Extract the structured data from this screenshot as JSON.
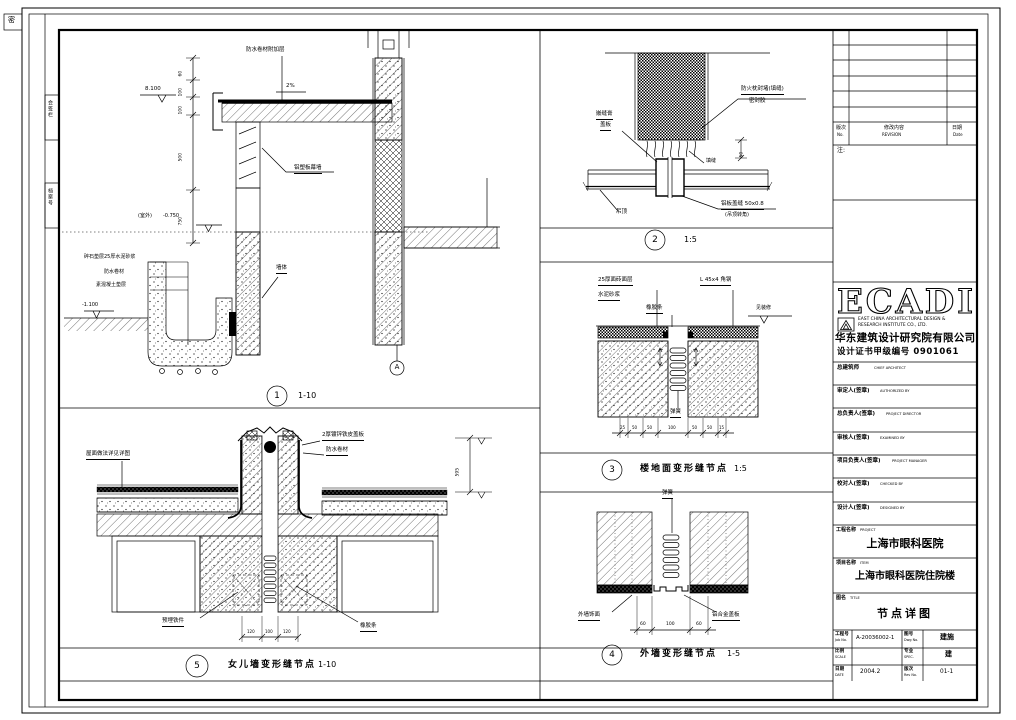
{
  "sheet": {
    "corner_stamp": "密",
    "strip_cell_1": "会签栏",
    "strip_cell_2": "档案号"
  },
  "revision_table": {
    "col_no_cn": "版次",
    "col_no_en": "No.",
    "col_rev_cn": "修改内容",
    "col_rev_en": "REVISION",
    "col_date_cn": "日期",
    "col_date_en": "Date",
    "note_label": "注:"
  },
  "ecadi": {
    "wordmark": "ECADI",
    "en_line1": "EAST CHINA ARCHITECTURAL DESIGN &",
    "en_line2": "RESEARCH INSTITUTE CO., LTD.",
    "cn_name": "华东建筑设计研究院有限公司",
    "cert_line": "设计证书甲级编号 0901061"
  },
  "signature_rows": [
    {
      "cn": "总建筑师",
      "en": "CHIEF ARCHITECT"
    },
    {
      "cn": "审定人(签章)",
      "en": "AUTHORIZED BY"
    },
    {
      "cn": "总负责人(签章)",
      "en": "PROJECT DIRECTOR"
    },
    {
      "cn": "审核人(签章)",
      "en": "EXAMINED BY"
    },
    {
      "cn": "项目负责人(签章)",
      "en": "PROJECT MANAGER"
    },
    {
      "cn": "校对人(签章)",
      "en": "CHECKED BY"
    },
    {
      "cn": "设计人(签章)",
      "en": "DESIGNED BY"
    }
  ],
  "project": {
    "label_cn": "工程名称",
    "label_en": "PROJECT",
    "value": "上海市眼科医院"
  },
  "subproject": {
    "label_cn": "项目名称",
    "label_en": "ITEM",
    "value": "上海市眼科医院住院楼"
  },
  "drawing_name": {
    "label_cn": "图名",
    "label_en": "TITLE",
    "value": "节点详图"
  },
  "info_grid": {
    "job_label_cn": "工程号",
    "job_label_en": "Job No.",
    "job_value": "A-20036002-1",
    "dwg_label_cn": "图号",
    "dwg_label_en": "Dwg No.",
    "dwg_value": "建施",
    "scale_label_cn": "比例",
    "scale_label_en": "SCALE",
    "scale_value": "",
    "spec_label_cn": "专业",
    "spec_label_en": "SPEC.",
    "spec_value": "建",
    "date_label_cn": "日期",
    "date_label_en": "DATE",
    "date_value": "2004.2",
    "rev_label_cn": "版次",
    "rev_label_en": "Rev No.",
    "rev_value": "01-1"
  },
  "details": {
    "d1": {
      "num": "1",
      "scale": "1-10",
      "elev_top": "8.100",
      "slope": "2%",
      "ann_membrane": "防水卷材附加层",
      "ann_curtain": "铝塑板幕墙",
      "ann_wall": "墙体",
      "ann_left_1": "碎石垫层25厚水泥砂浆",
      "ann_left_2": "防水卷材",
      "ann_left_3": "素混凝土垫层",
      "elev_mid_prefix": "(室外)",
      "elev_mid": "-0.750",
      "elev_ground": "-1.100",
      "grid_bubble": "A",
      "dims": [
        "60",
        "100",
        "100",
        "500",
        "750"
      ]
    },
    "d2": {
      "num": "2",
      "scale": "1:5",
      "ann_right_1": "防火枕封堵(填缝)",
      "ann_right_2": "密封胶",
      "ann_left_1": "嵌缝膏",
      "ann_left_2": "盖板",
      "ann_mid": "填缝",
      "ann_br_1": "铝板盖缝 50x0.8",
      "ann_br_2": "(吊顶转角)",
      "ann_bl": "吊顶",
      "dim": "50"
    },
    "d3": {
      "num": "3",
      "title": "楼地面变形缝节点",
      "scale": "1:5",
      "ann_1": "25厚面砖面层",
      "ann_2": "水泥砂浆",
      "ann_3": "橡胶条",
      "ann_4": "L 45x4 角钢",
      "elev_note": "见装修",
      "ann_bottom": "弹簧",
      "dims": [
        "25",
        "50",
        "50",
        "100",
        "50",
        "50",
        "15"
      ]
    },
    "d4": {
      "num": "4",
      "title": "外墙变形缝节点",
      "scale": "1-5",
      "ann_top": "弹簧",
      "ann_bl": "外墙饰面",
      "ann_br": "铝合金盖板",
      "dims": [
        "60",
        "100",
        "60"
      ]
    },
    "d5": {
      "num": "5",
      "title": "女儿墙变形缝节点",
      "scale": "1-10",
      "ann_left": "屋面做法详见详图",
      "ann_top_1": "2厚镀锌铁皮盖板",
      "ann_top_2": "防水卷材",
      "ann_bl": "预埋铁件",
      "ann_br": "橡胶条",
      "dim_right": "595",
      "dims": [
        "120",
        "100",
        "120"
      ]
    }
  }
}
